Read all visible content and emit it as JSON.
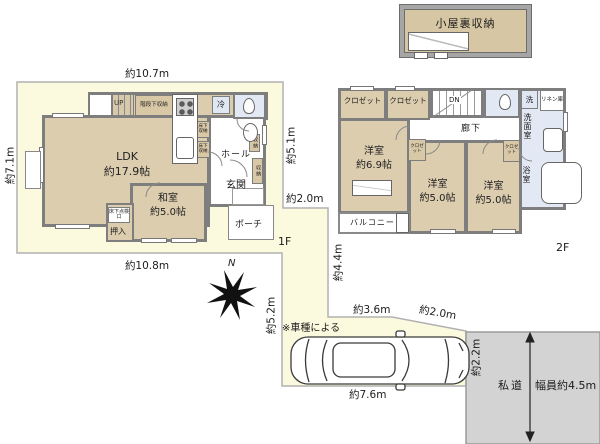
{
  "attic": {
    "label": "小屋裏収納"
  },
  "floor1": {
    "floor_label": "1F",
    "dims": {
      "top": "約10.7m",
      "left": "約7.1m",
      "bottom": "約10.8m",
      "right": "約5.1m",
      "gap": "約2.0m"
    },
    "rooms": {
      "ldk": {
        "name": "LDK",
        "size": "約17.9帖"
      },
      "washitsu": {
        "name": "和室",
        "size": "約5.0帖"
      },
      "oshiire": "押入",
      "floor_hatch": "床下点検口",
      "hall": "ホール",
      "genkan": "玄関",
      "porch": "ポーチ",
      "stairs": "UP",
      "under_stair_storage": "階段下収納",
      "fridge": "冷",
      "floor_storage_1": "床下収納",
      "floor_storage_2": "床下収納",
      "cabinet_1": "収納",
      "cabinet_2": "収納"
    }
  },
  "floor2": {
    "floor_label": "2F",
    "rooms": {
      "closet_1": "クロゼット",
      "closet_2": "クロゼット",
      "stairs": "DN",
      "hallway": "廊下",
      "washer": "洗",
      "linen": "リネン庫",
      "sanitary": "洗面室",
      "bath": "浴室",
      "west_room": {
        "name": "洋室",
        "size": "約6.9帖"
      },
      "center_room": {
        "name": "洋室",
        "size": "約5.0帖"
      },
      "east_room": {
        "name": "洋室",
        "size": "約5.0帖"
      },
      "closet_small_1": "クロゼット",
      "closet_small_2": "クロゼット",
      "balcony": "バルコニー"
    }
  },
  "site": {
    "north": "N",
    "note": "※車種による",
    "dims": {
      "approach_v": "約4.4m",
      "west_v": "約5.2m",
      "drive_top": "約3.6m",
      "drive_diag": "約2.0m",
      "drive_bottom": "約7.6m",
      "road_edge": "約2.2m"
    },
    "road": {
      "name": "私道",
      "width": "幅員約4.5m"
    }
  },
  "colors": {
    "lot_fill": "#fcfade",
    "room_fill": "#dccdaf",
    "wet_fill": "#e3e9f4",
    "road_fill": "#d3d3d3",
    "wall": "#7e7e7e"
  }
}
